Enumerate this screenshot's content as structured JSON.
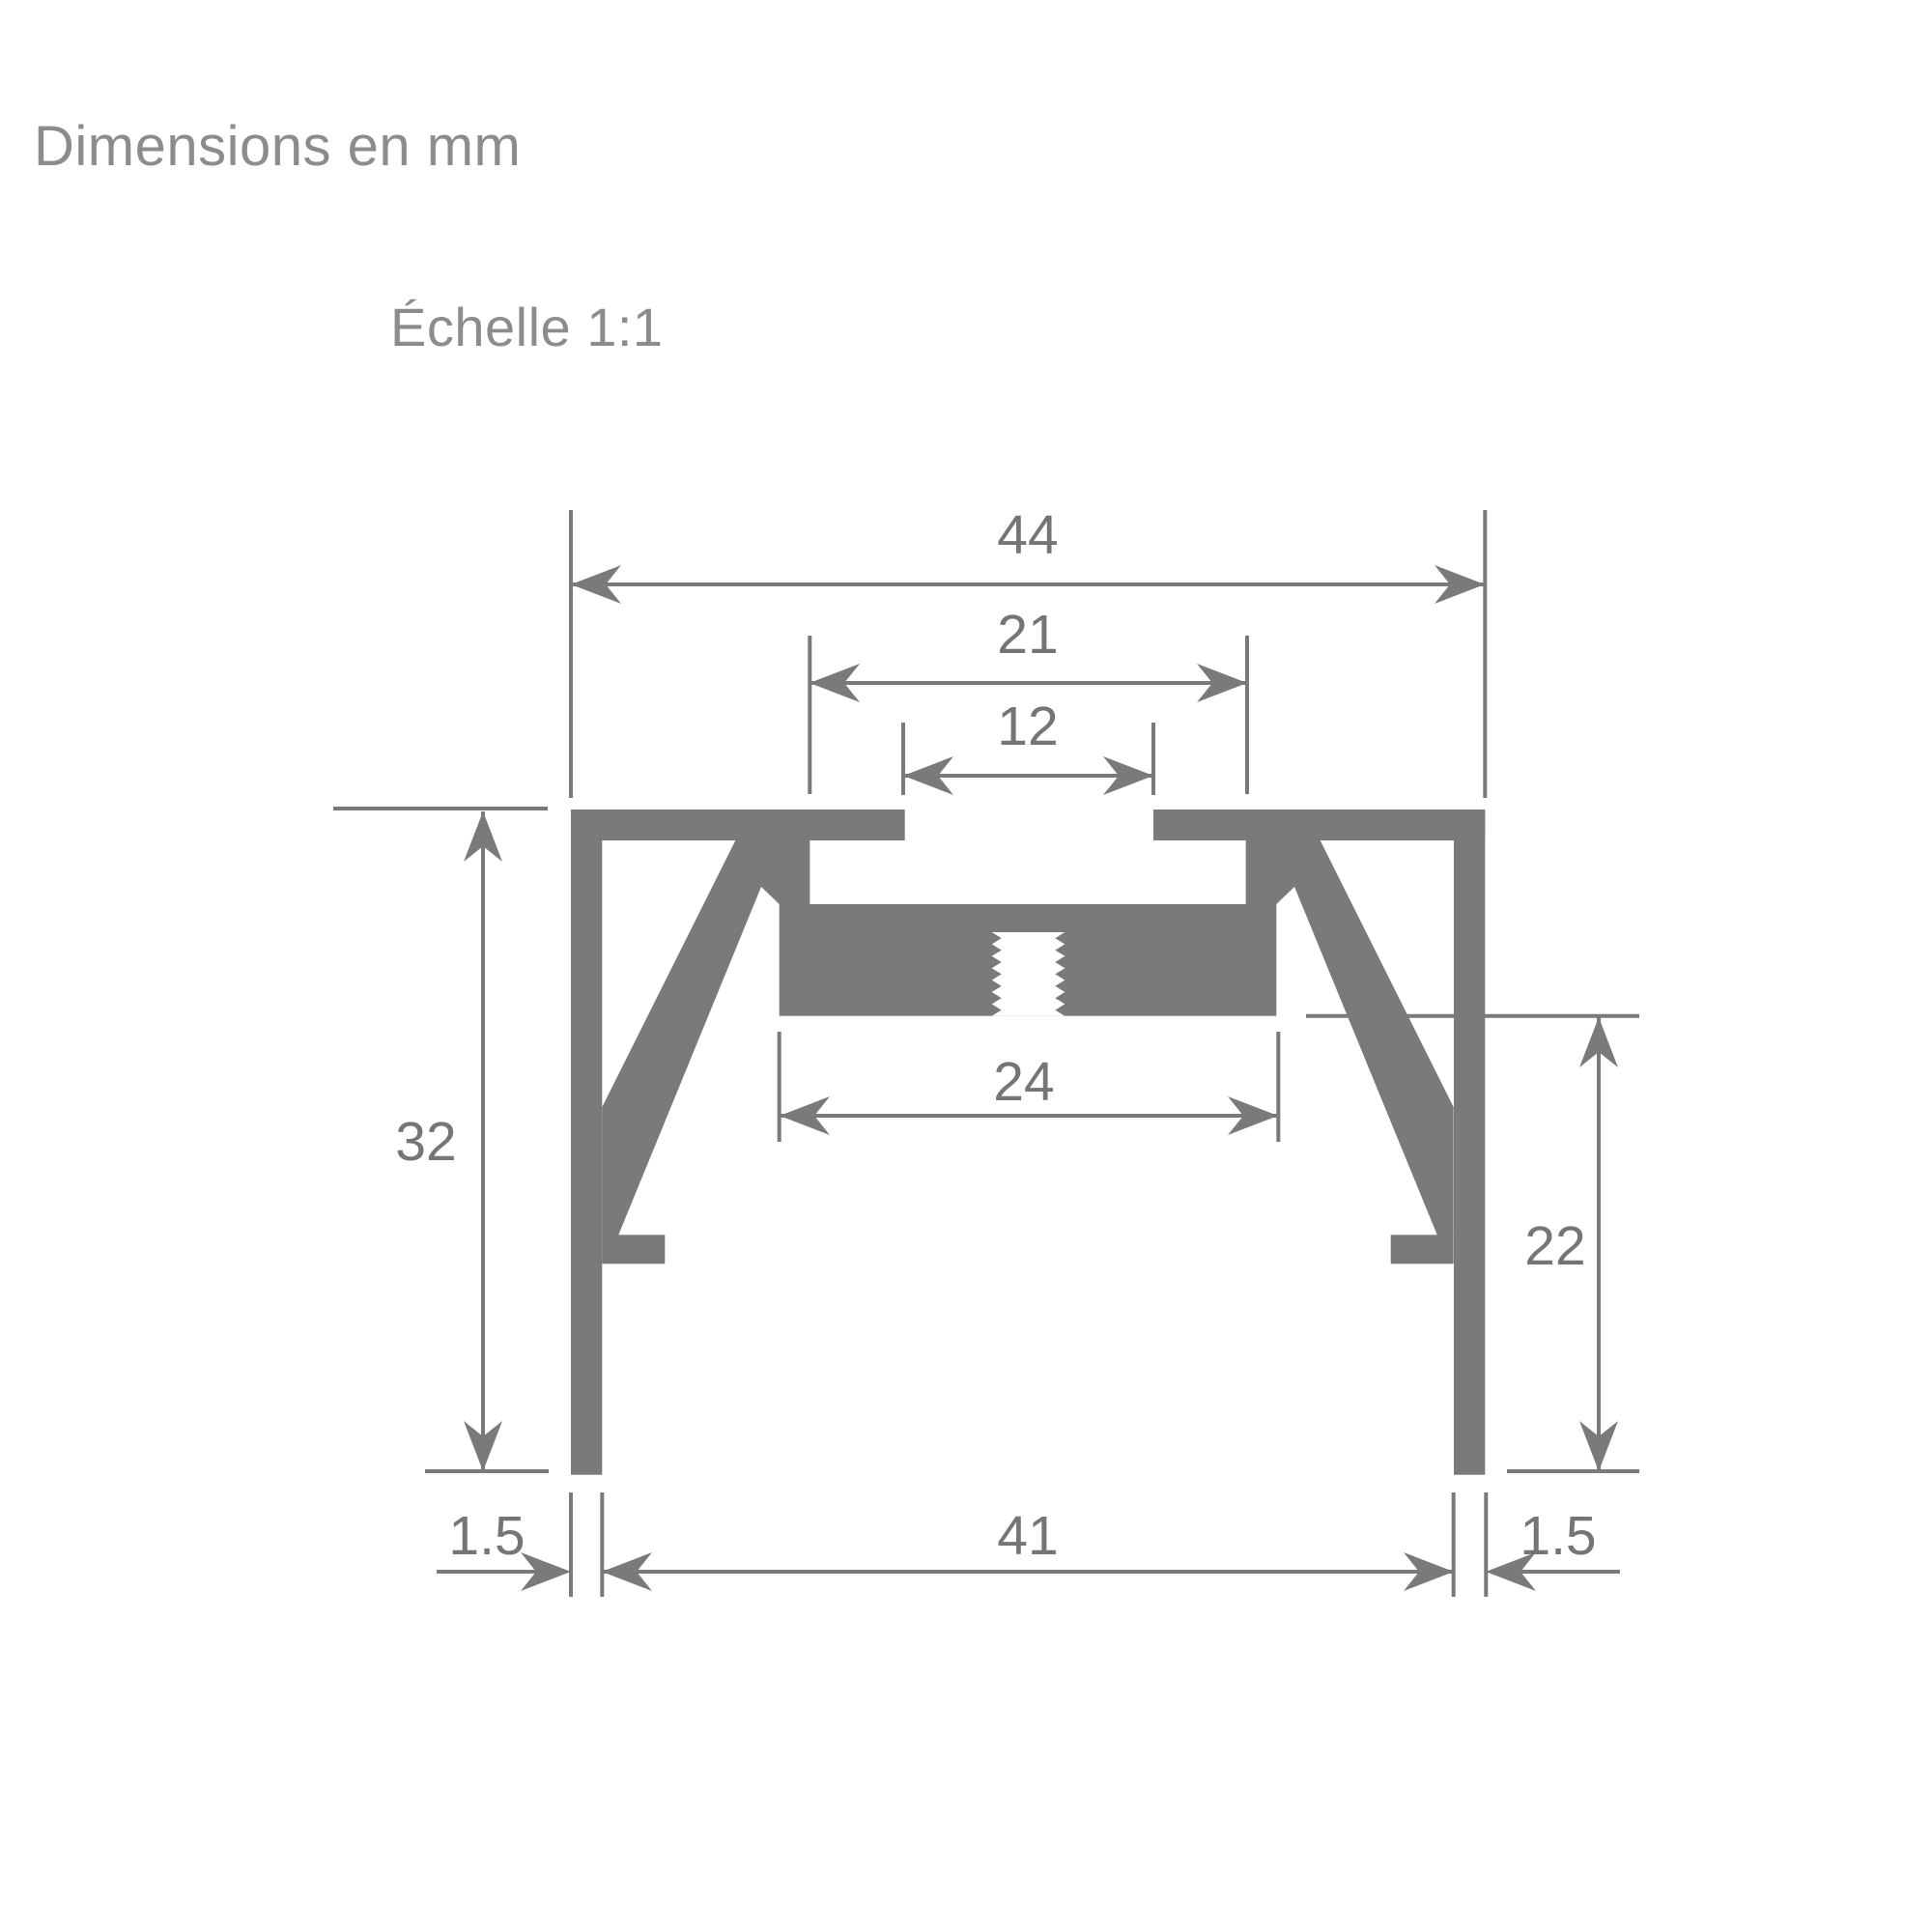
{
  "header": {
    "units_note": "Dimensions en mm",
    "scale_note": "Échelle 1:1"
  },
  "dimensions": {
    "overall_width": "44",
    "cavity_width": "21",
    "slot_width": "12",
    "block_width": "24",
    "overall_height": "32",
    "side_height": "22",
    "inner_gap": "41",
    "wall_left": "1.5",
    "wall_right": "1.5"
  },
  "colors": {
    "shape": "#7a7a7a",
    "line": "#7a7a7a",
    "dim-text": "#757575",
    "header-text": "#8c8c8c",
    "bg": "#ffffff"
  }
}
